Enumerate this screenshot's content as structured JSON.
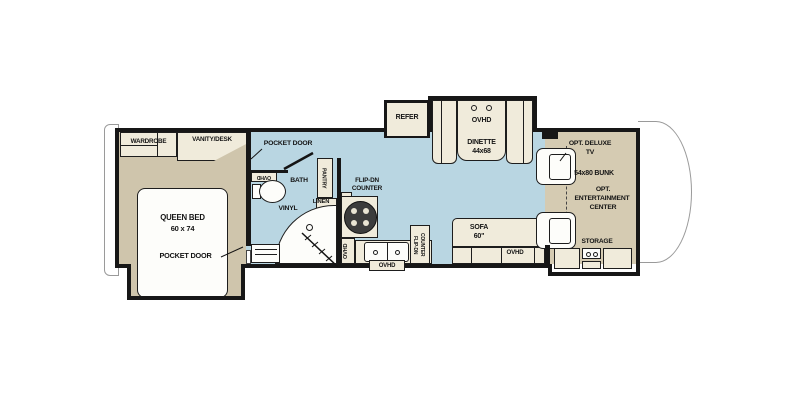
{
  "floorplan": {
    "bedroom": {
      "wardrobe": "WARDROBE",
      "vanity_desk": "VANITY/DESK",
      "bed_name": "QUEEN BED",
      "bed_size": "60 x 74",
      "pocket_door": "POCKET DOOR"
    },
    "bath": {
      "pocket_door": "POCKET DOOR",
      "ovhd": "OVHD",
      "name": "BATH",
      "flooring": "VINYL",
      "linen": "LINEN",
      "pantry": "PANTRY"
    },
    "kitchen": {
      "flip_counter_l1": "FLIP-DN",
      "flip_counter_l2": "COUNTER",
      "ovhd_wall": "OVHD",
      "ovhd_sink": "OVHD",
      "flip_counter_r1": "FLIP-DN",
      "flip_counter_r2": "COUNTER"
    },
    "dinette": {
      "refer": "REFER",
      "ovhd": "OVHD",
      "name": "DINETTE",
      "size": "44x68"
    },
    "living": {
      "sofa": "SOFA",
      "sofa_size": "60\"",
      "ovhd": "OVHD"
    },
    "front": {
      "opt_tv_l1": "OPT. DELUXE",
      "opt_tv_l2": "TV",
      "bunk": "54x80 BUNK",
      "ent_l1": "OPT.",
      "ent_l2": "ENTERTAINMENT",
      "ent_l3": "CENTER",
      "storage": "STORAGE"
    },
    "colors": {
      "vinyl_floor": "#b9d6e2",
      "carpet_floor": "#cfc5ac",
      "slide_floor": "#d5cbb2",
      "furniture": "#f0ebdb",
      "wall": "#171717"
    }
  }
}
